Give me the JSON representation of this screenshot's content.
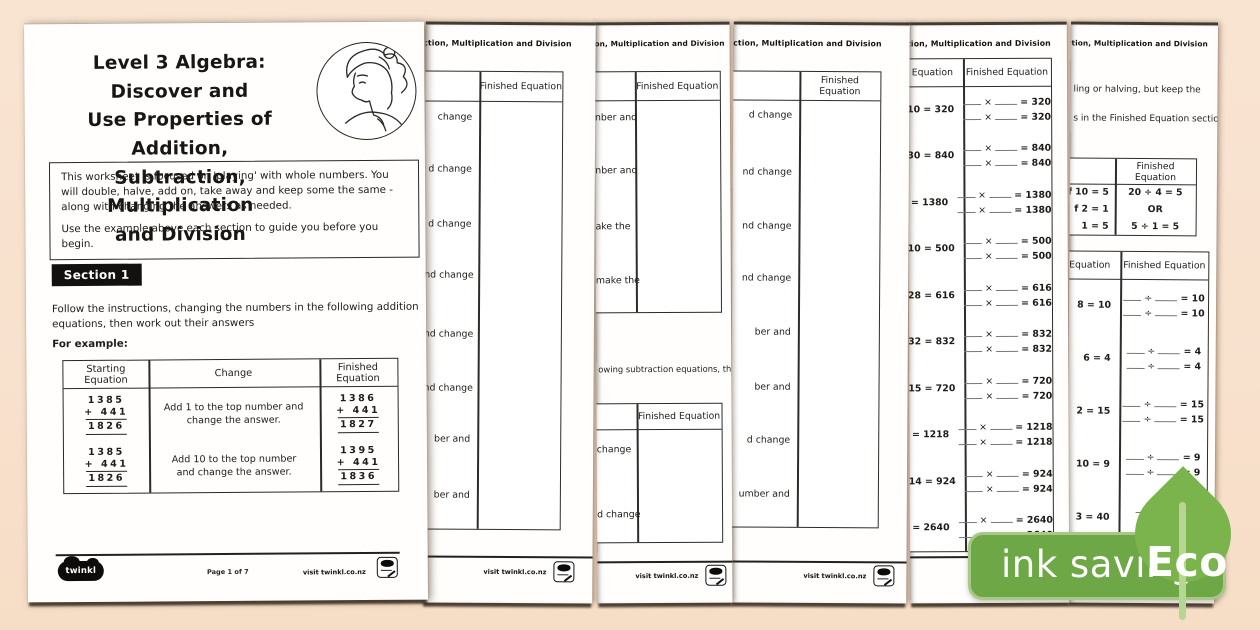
{
  "shared": {
    "header_fragment": "btraction, Multiplication and Division",
    "finished_equation": "Finished Equation",
    "visit": "visit twinkl.co.nz",
    "logo_text": "twinkl"
  },
  "badge": {
    "label": "ink saving",
    "eco": "Eco",
    "green": "#6ea746",
    "leaf_green": "#7bb44d"
  },
  "page1": {
    "title_lines": [
      "Level 3 Algebra: Discover and",
      "Use Properties of Addition,",
      "Subtraction, Multiplication",
      "and Division"
    ],
    "intro": [
      "This worksheet is focused on 'playing' with whole numbers. You will double, halve, add on, take away and keep some the same - along with changing the answers as needed.",
      "Use the example above each section to guide you before you begin."
    ],
    "section_label": "Section 1",
    "instructions": "Follow the instructions, changing the numbers in the following addition equations, then work out their answers",
    "for_example": "For example:",
    "table": {
      "headers": [
        "Starting Equation",
        "Change",
        "Finished Equation"
      ],
      "rows": [
        {
          "start_top": "1385",
          "start_add": "+ 441",
          "start_sum": "1826",
          "change": "Add 1 to the top number and change the answer.",
          "fin_top": "1386",
          "fin_add": "+ 441",
          "fin_sum": "1827"
        },
        {
          "start_top": "1385",
          "start_add": "+ 441",
          "start_sum": "1826",
          "change": "Add 10 to the top number and change the answer.",
          "fin_top": "1395",
          "fin_add": "+ 441",
          "fin_sum": "1836"
        }
      ]
    },
    "footer": {
      "page_info": "Page 1 of 7"
    }
  },
  "page2": {
    "fragments": [
      "change",
      "d change",
      "d change",
      "nd change",
      "nd change",
      "nd change",
      "ber and",
      "ber and"
    ]
  },
  "page3": {
    "fragments_top": [
      "nber and",
      "nber and",
      "ake the",
      "make the"
    ],
    "mid_text": "owing subtraction equations, then",
    "fragments_bottom": [
      "change",
      "d change"
    ]
  },
  "page4": {
    "fragments": [
      "d change",
      "nd change",
      "nd change",
      "nd change",
      "ber and",
      "ber and",
      "d change",
      "umber and"
    ]
  },
  "page5": {
    "header_left": "g Equation",
    "op": "×",
    "rows": [
      {
        "label": "10 = 320",
        "res": "= 320"
      },
      {
        "label": "30 = 840",
        "res": "= 840"
      },
      {
        "label": "30 = 1380",
        "res": "= 1380"
      },
      {
        "label": "10 = 500",
        "res": "= 500"
      },
      {
        "label": "28 = 616",
        "res": "= 616"
      },
      {
        "label": "32 = 832",
        "res": "= 832"
      },
      {
        "label": "15 = 720",
        "res": "= 720"
      },
      {
        "label": "21 = 1218",
        "res": "= 1218"
      },
      {
        "label": "14 = 924",
        "res": "= 924"
      },
      {
        "label": "22 = 2640",
        "res": "= 2640"
      }
    ]
  },
  "page6": {
    "text_lines": [
      "ling or halving, but keep the",
      "s in the Finished Equation section."
    ],
    "example_rows": [
      {
        "left": "f 10 = 5",
        "right": "20 ÷ 4 = 5"
      },
      {
        "left": "f 2 = 1",
        "right": "OR"
      },
      {
        "left": "1 = 5",
        "right": "5 ÷ 1 = 5"
      }
    ],
    "header_left": "Equation",
    "op": "÷",
    "rows": [
      {
        "label": "8 = 10",
        "res": "= 10"
      },
      {
        "label": "6 = 4",
        "res": "= 4"
      },
      {
        "label": "2 = 15",
        "res": "= 15"
      },
      {
        "label": "10 = 9",
        "res": "= 9"
      },
      {
        "label": "3 = 40",
        "res": ""
      }
    ]
  }
}
